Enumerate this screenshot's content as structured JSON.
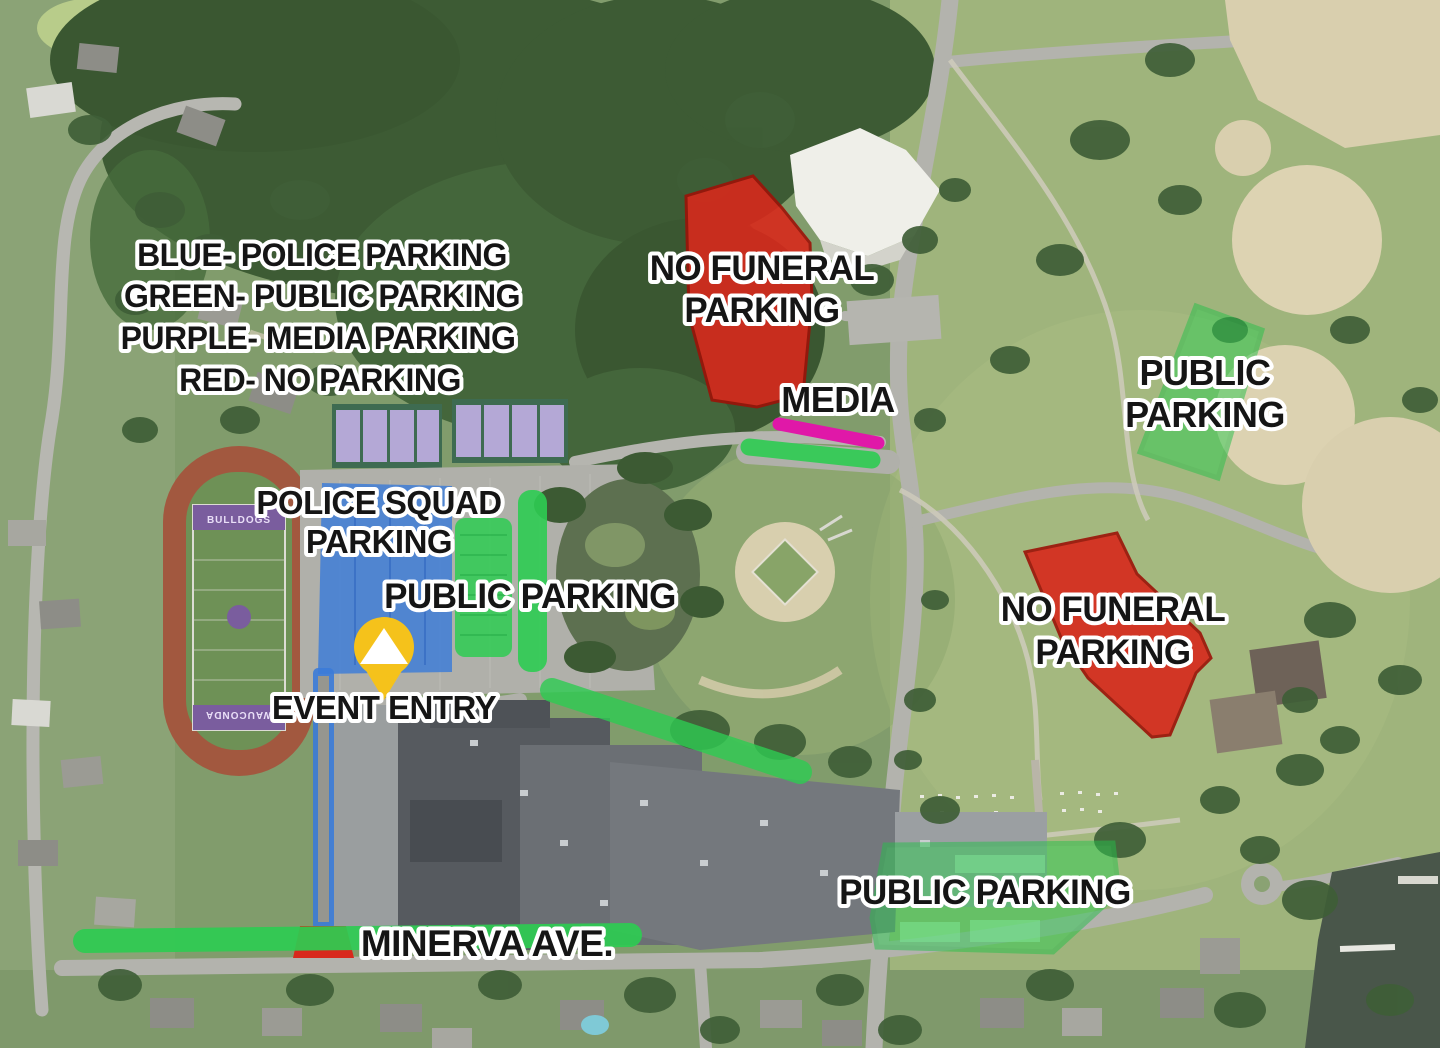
{
  "legend": {
    "lines": [
      "BLUE- POLICE PARKING",
      "GREEN- PUBLIC PARKING",
      "PURPLE- MEDIA PARKING",
      "RED- NO PARKING"
    ]
  },
  "labels": {
    "no_funeral_north": {
      "lines": [
        "NO FUNERAL",
        "PARKING"
      ]
    },
    "media": {
      "text": "MEDIA"
    },
    "public_parking_east": {
      "lines": [
        "PUBLIC",
        "PARKING"
      ]
    },
    "police_squad": {
      "lines": [
        "POLICE SQUAD",
        "PARKING"
      ]
    },
    "public_parking_center": {
      "text": "PUBLIC PARKING"
    },
    "event_entry": {
      "text": "EVENT ENTRY"
    },
    "no_funeral_south": {
      "lines": [
        "NO FUNERAL",
        "PARKING"
      ]
    },
    "public_parking_south": {
      "text": "PUBLIC PARKING"
    },
    "minerva_ave": {
      "text": "MINERVA AVE."
    }
  },
  "field": {
    "north_endzone": "BULLDOGS",
    "south_endzone": "WAUCONDA"
  },
  "colors": {
    "police_blue": "#3b7bd8",
    "public_green": "#2ecc52",
    "media_purple": "#e018a8",
    "no_parking_red": "#d8291c",
    "event_entry_yellow": "#f5c21b"
  }
}
